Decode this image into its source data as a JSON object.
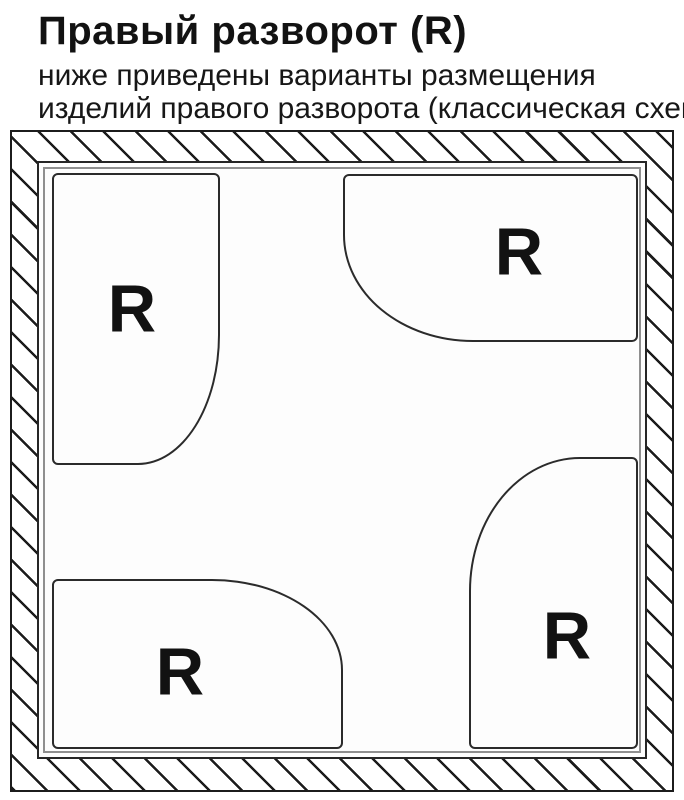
{
  "header": {
    "title": "Правый разворот (R)",
    "subtitle_line1": "ниже приведены варианты размещения",
    "subtitle_line2": "изделий правого разворота (классическая схема)"
  },
  "diagram": {
    "description": "room plan with hatched walls and four right-orientation trays",
    "shapes": [
      {
        "position": "top-left",
        "label": "R",
        "rounded_corner": "bottom-right"
      },
      {
        "position": "top-right",
        "label": "R",
        "rounded_corner": "bottom-left"
      },
      {
        "position": "bottom-left",
        "label": "R",
        "rounded_corner": "top-right"
      },
      {
        "position": "bottom-right",
        "label": "R",
        "rounded_corner": "top-left"
      }
    ],
    "colors": {
      "ink": "#1c1c1c",
      "wall_line": "#8f8f8f",
      "background": "#ffffff"
    }
  }
}
